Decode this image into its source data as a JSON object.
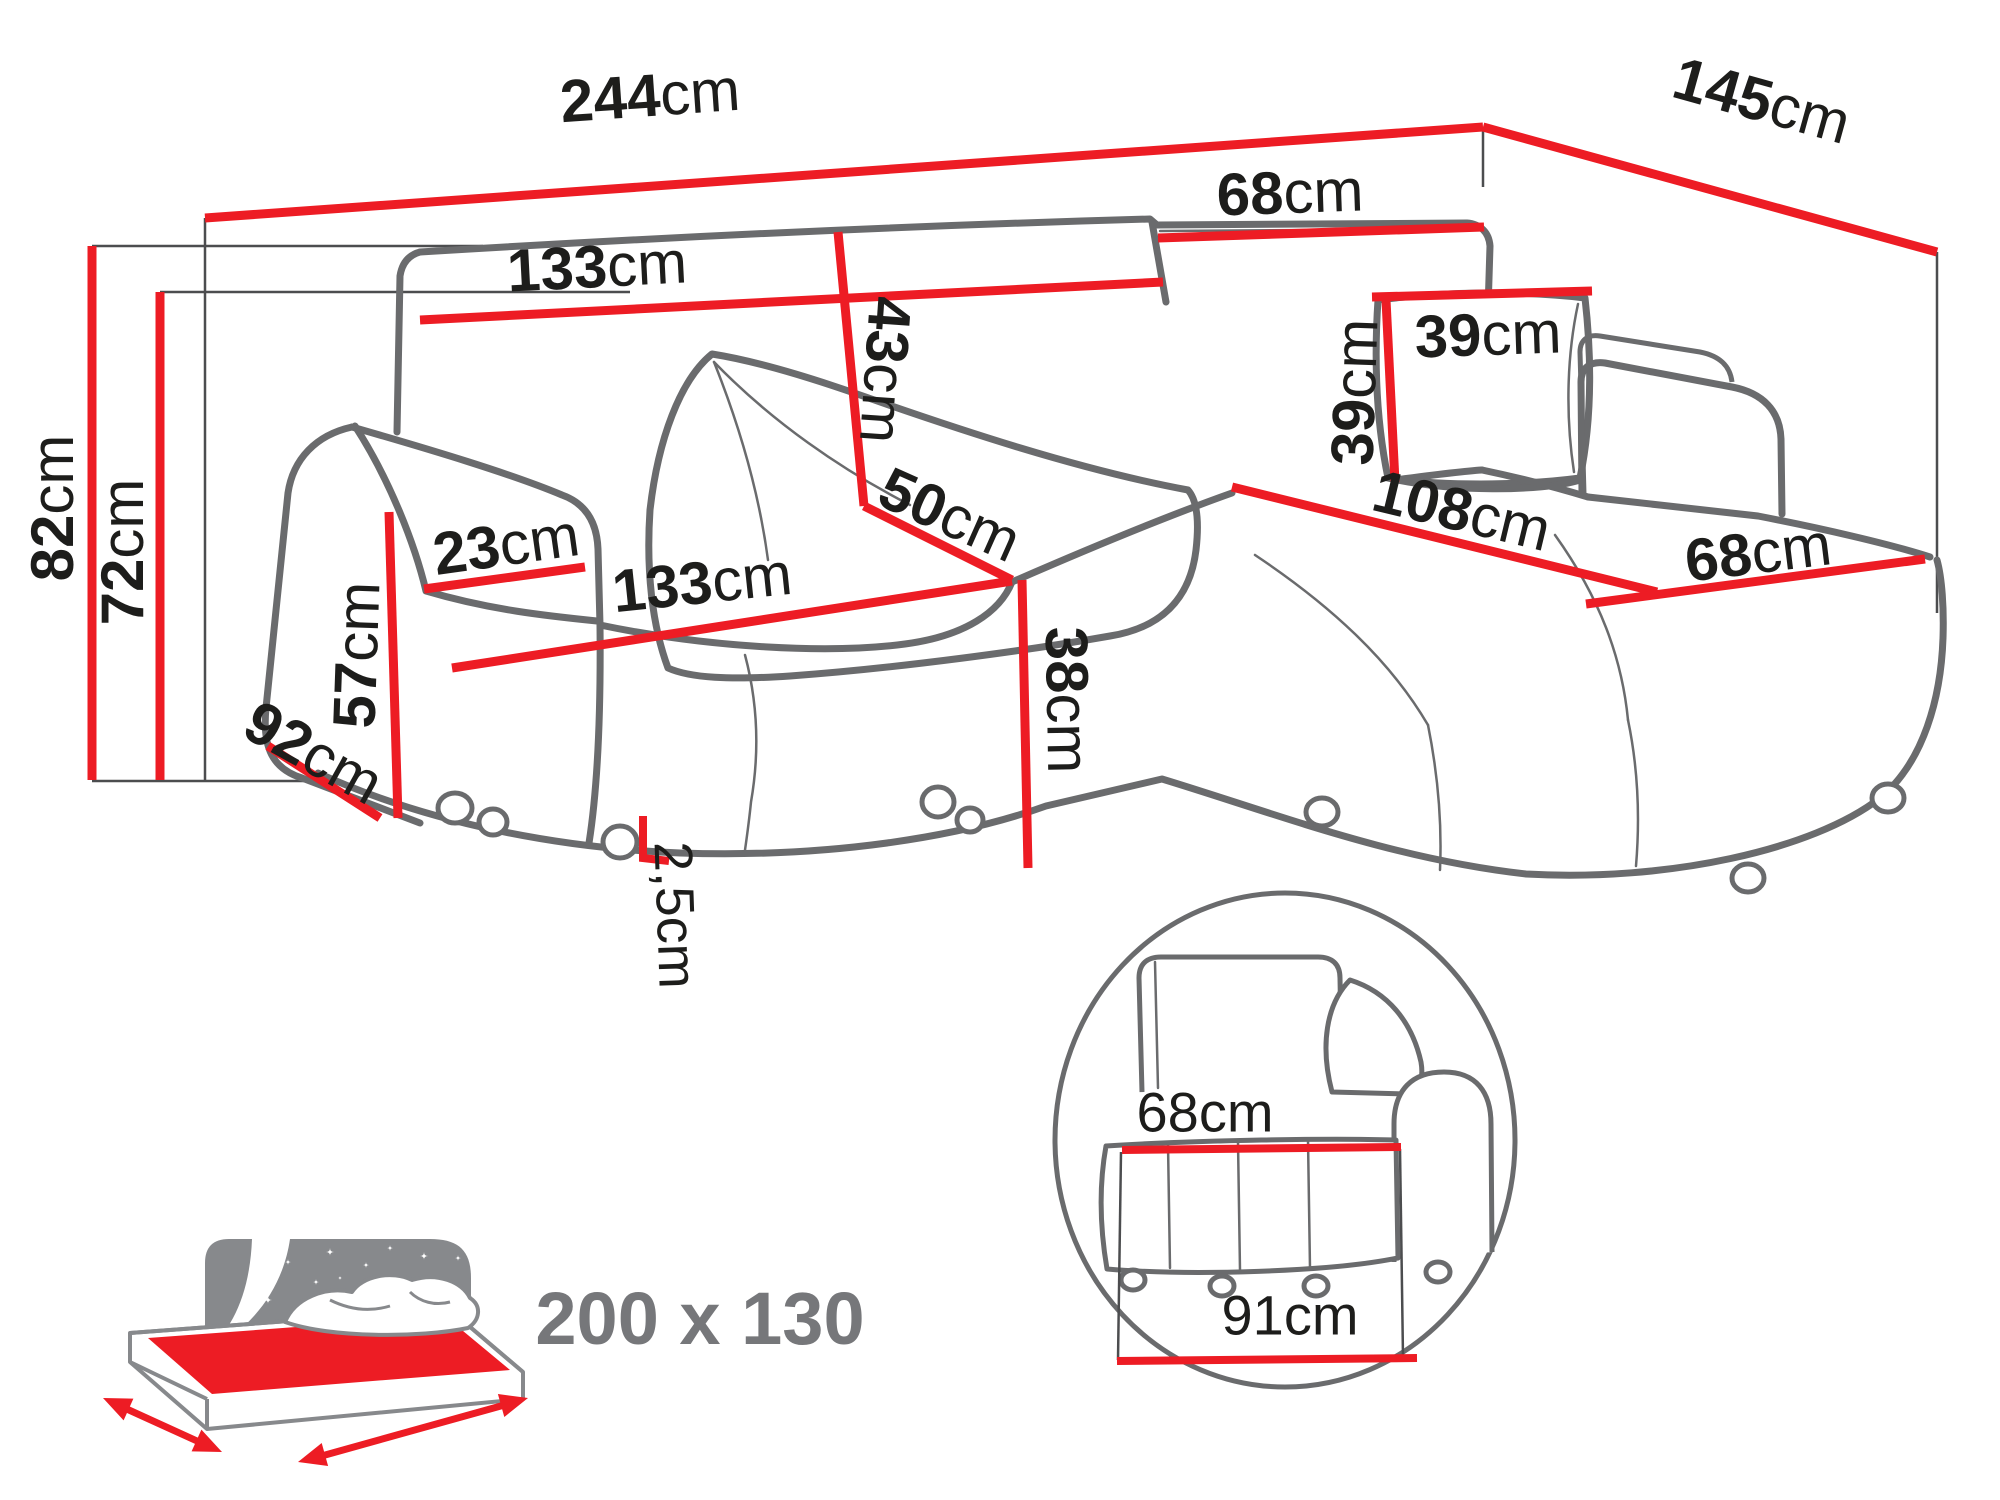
{
  "page": {
    "background": "#ffffff",
    "description": "Corner sofa-bed technical dimension drawing"
  },
  "colors": {
    "dimension_red": "#ed1c24",
    "outline_gray": "#6a6b6d",
    "reference_line_gray": "#4c4d4f",
    "label_black": "#1d1d1b",
    "icon_gray": "#87898c",
    "icon_text_gray": "#76777a"
  },
  "sofa_dimensions": {
    "total_width": {
      "value": "244",
      "unit": "cm"
    },
    "total_depth": {
      "value": "145",
      "unit": "cm"
    },
    "total_height": {
      "value": "82",
      "unit": "cm"
    },
    "height_without_top_cushion": {
      "value": "72",
      "unit": "cm"
    },
    "back_cushion_width": {
      "value": "133",
      "unit": "cm"
    },
    "back_cushion_height": {
      "value": "43",
      "unit": "cm"
    },
    "corner_back_cushion_width": {
      "value": "68",
      "unit": "cm"
    },
    "pillow_width": {
      "value": "39",
      "unit": "cm"
    },
    "pillow_height": {
      "value": "39",
      "unit": "cm"
    },
    "seat_depth_at_corner": {
      "value": "50",
      "unit": "cm"
    },
    "seat_width": {
      "value": "133",
      "unit": "cm"
    },
    "seat_height": {
      "value": "38",
      "unit": "cm"
    },
    "chaise_length": {
      "value": "108",
      "unit": "cm"
    },
    "chaise_width": {
      "value": "68",
      "unit": "cm"
    },
    "armrest_width": {
      "value": "23",
      "unit": "cm"
    },
    "armrest_height": {
      "value": "57",
      "unit": "cm"
    },
    "armrest_depth": {
      "value": "92",
      "unit": "cm"
    },
    "leg_height": {
      "value": "2,5",
      "unit": "cm"
    }
  },
  "sleeping_function": {
    "bed_size_label": "200 x 130"
  },
  "detail_view": {
    "seat_depth": {
      "value": "68",
      "unit": "cm"
    },
    "base_depth": {
      "value": "91",
      "unit": "cm"
    }
  }
}
